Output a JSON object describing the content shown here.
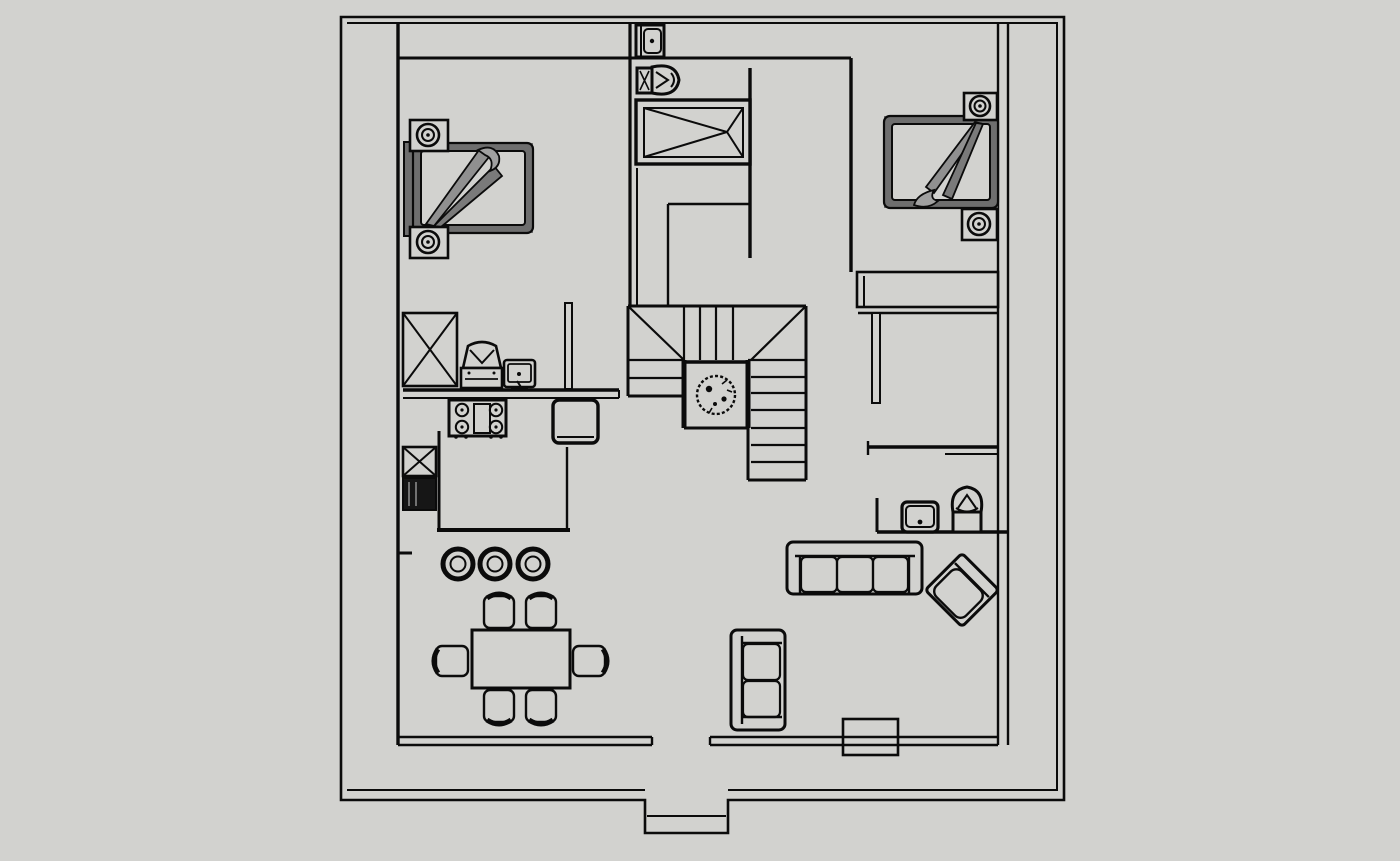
{
  "canvas": {
    "colors": {
      "bg": "#d2d2cf",
      "line": "#0b0b0b",
      "shade": "#6e6e6e",
      "shade-dark": "#4a4a4a",
      "blanket": "#909090",
      "blanket2": "#7a7a7a",
      "blanket3": "#a0a0a0",
      "appliance-dark": "#161616"
    },
    "description": "monochrome architectural floor plan on plain gray canvas, no text labels"
  },
  "plan": {
    "type": "floor-plan-top-view",
    "objects": [
      {
        "id": "exterior-wall",
        "kind": "structure",
        "count": 1
      },
      {
        "id": "entry-porch",
        "kind": "structure",
        "count": 1
      },
      {
        "id": "interior-walls",
        "kind": "structure",
        "count": 1
      },
      {
        "id": "staircase-u-shaped",
        "kind": "structure",
        "count": 1
      },
      {
        "id": "stair-landing-plant",
        "kind": "decor",
        "count": 1
      },
      {
        "id": "double-bed",
        "kind": "furniture",
        "count": 2
      },
      {
        "id": "nightstand-with-lamp",
        "kind": "furniture",
        "count": 4
      },
      {
        "id": "bathroom-sink",
        "kind": "fixture",
        "count": 1
      },
      {
        "id": "toilet",
        "kind": "fixture",
        "count": 2
      },
      {
        "id": "bathtub",
        "kind": "fixture",
        "count": 1
      },
      {
        "id": "tall-cabinet-x",
        "kind": "furniture",
        "count": 1
      },
      {
        "id": "coffee-machine",
        "kind": "appliance",
        "count": 1
      },
      {
        "id": "countertop-tv",
        "kind": "appliance",
        "count": 1
      },
      {
        "id": "kitchen-counter",
        "kind": "furniture",
        "count": 1
      },
      {
        "id": "stove-four-burner",
        "kind": "appliance",
        "count": 1
      },
      {
        "id": "kitchen-sink-cabinet",
        "kind": "fixture",
        "count": 1
      },
      {
        "id": "refrigerator",
        "kind": "appliance",
        "count": 1
      },
      {
        "id": "kitchen-island",
        "kind": "furniture",
        "count": 1
      },
      {
        "id": "bar-stool",
        "kind": "furniture",
        "count": 3
      },
      {
        "id": "dining-table",
        "kind": "furniture",
        "count": 1
      },
      {
        "id": "dining-chair",
        "kind": "furniture",
        "count": 6
      },
      {
        "id": "sofa-three-seat",
        "kind": "furniture",
        "count": 1
      },
      {
        "id": "accent-armchair-rotated",
        "kind": "furniture",
        "count": 1
      },
      {
        "id": "loveseat",
        "kind": "furniture",
        "count": 1
      },
      {
        "id": "powder-room-sink",
        "kind": "fixture",
        "count": 1
      },
      {
        "id": "wardrobe",
        "kind": "furniture",
        "count": 1
      },
      {
        "id": "window",
        "kind": "structure",
        "count": 1
      }
    ]
  }
}
